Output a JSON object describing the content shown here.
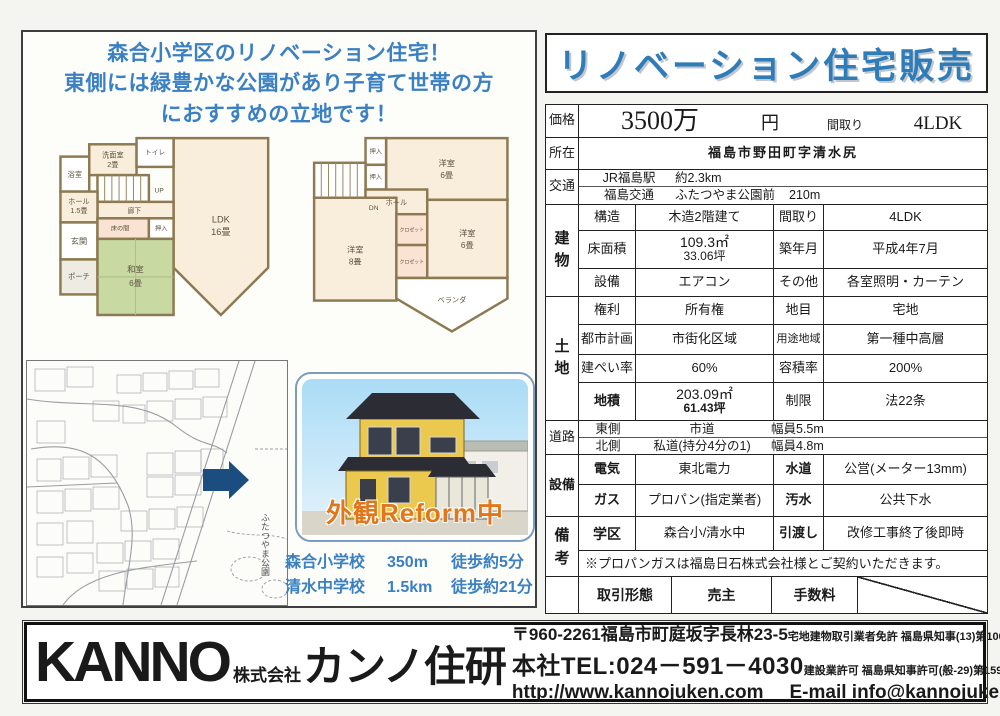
{
  "headline": {
    "line1": "森合小学区のリノベーション住宅！",
    "line2": "東側には緑豊かな公園があり子育て世帯の方",
    "line3": "におすすめの立地です！"
  },
  "floorplan1": {
    "bath": "浴室",
    "washroom": "洗面室",
    "washroom_size": "2畳",
    "toilet": "トイレ",
    "up": "UP",
    "corridor": "廊下",
    "hall": "ホール",
    "hall_size": "1.5畳",
    "entrance": "玄関",
    "porch": "ポーチ",
    "tokonoma": "床の間",
    "closet": "押入",
    "tatami": "和室",
    "tatami_size": "6畳",
    "ldk": "LDK",
    "ldk_size": "16畳"
  },
  "floorplan2": {
    "closet1": "押入",
    "closet2": "押入",
    "dn": "DN",
    "hall": "ホール",
    "room1": "洋室",
    "room1_size": "6畳",
    "room2": "洋室",
    "room2_size": "8畳",
    "room3": "洋室",
    "room3_size": "6畳",
    "closet3": "クロゼット",
    "closet4": "クロゼット",
    "veranda": "ベランダ"
  },
  "map": {
    "park": "ふたつやま公園"
  },
  "photo": {
    "caption": "外観Reform中"
  },
  "schools": {
    "s1_name": "森合小学校",
    "s1_dist": "350m",
    "s1_walk": "徒歩約5分",
    "s2_name": "清水中学校",
    "s2_dist": "1.5km",
    "s2_walk": "徒歩約21分"
  },
  "title": "リノベーション住宅販売",
  "spec": {
    "price": {
      "label": "価格",
      "value": "3500万",
      "unit": "円",
      "madori_label": "間取り",
      "madori": "4LDK"
    },
    "location": {
      "label": "所在",
      "value": "福島市野田町字清水尻"
    },
    "access": {
      "label": "交通",
      "line1_name": "JR福島駅",
      "line1_dist": "約2.3km",
      "line2_name": "福島交通",
      "line2_stop": "ふたつやま公園前",
      "line2_dist": "210m"
    },
    "building": {
      "label": "建物",
      "rows": [
        {
          "k1": "構造",
          "v1": "木造2階建て",
          "k2": "間取り",
          "v2": "4LDK"
        },
        {
          "k1": "床面積",
          "v1a": "109.3㎡",
          "v1b": "33.06坪",
          "k2": "築年月",
          "v2": "平成4年7月"
        },
        {
          "k1": "設備",
          "v1": "エアコン",
          "k2": "その他",
          "v2": "各室照明・カーテン"
        }
      ]
    },
    "land": {
      "label": "土地",
      "rows": [
        {
          "k1": "権利",
          "v1": "所有権",
          "k2": "地目",
          "v2": "宅地"
        },
        {
          "k1": "都市計画",
          "v1": "市街化区域",
          "k2": "用途地域",
          "v2": "第一種中高層"
        },
        {
          "k1": "建ぺい率",
          "v1": "60%",
          "k2": "容積率",
          "v2": "200%"
        },
        {
          "k1": "地積",
          "v1a": "203.09㎡",
          "v1b": "61.43坪",
          "k2": "制限",
          "v2": "法22条"
        }
      ]
    },
    "road": {
      "label": "道路",
      "row1": {
        "side": "東側",
        "type": "市道",
        "width": "幅員5.5m"
      },
      "row2": {
        "side": "北側",
        "type": "私道(持分4分の1)",
        "width": "幅員4.8m"
      }
    },
    "utilities": {
      "label": "設備",
      "rows": [
        {
          "k1": "電気",
          "v1": "東北電力",
          "k2": "水道",
          "v2": "公営(メーター13mm)"
        },
        {
          "k1": "ガス",
          "v1": "プロパン(指定業者)",
          "k2": "汚水",
          "v2": "公共下水"
        }
      ]
    },
    "notes": {
      "label": "備考",
      "row": {
        "k1": "学区",
        "v1": "森合小/清水中",
        "k2": "引渡し",
        "v2": "改修工事終了後即時"
      },
      "note": "※プロパンガスは福島日石株式会社様とご契約いただきます。"
    }
  },
  "deal": {
    "c1": "取引形態",
    "c2": "売主",
    "c3": "手数料"
  },
  "footer": {
    "logo_en": "KANNO",
    "logo_kk": "株式会社",
    "logo_jp": "カンノ住研",
    "address": "〒960-2261福島市町庭坂字長林23-5",
    "tel": "本社TEL:024－591－4030",
    "url": "http://www.kannojuken.com",
    "email": "E-mail info@kannojuken.com",
    "license1": "宅地建物取引業者免許 福島県知事(13)第10095号",
    "license2": "建設業許可 福島県知事許可(般-29)第1598号"
  }
}
